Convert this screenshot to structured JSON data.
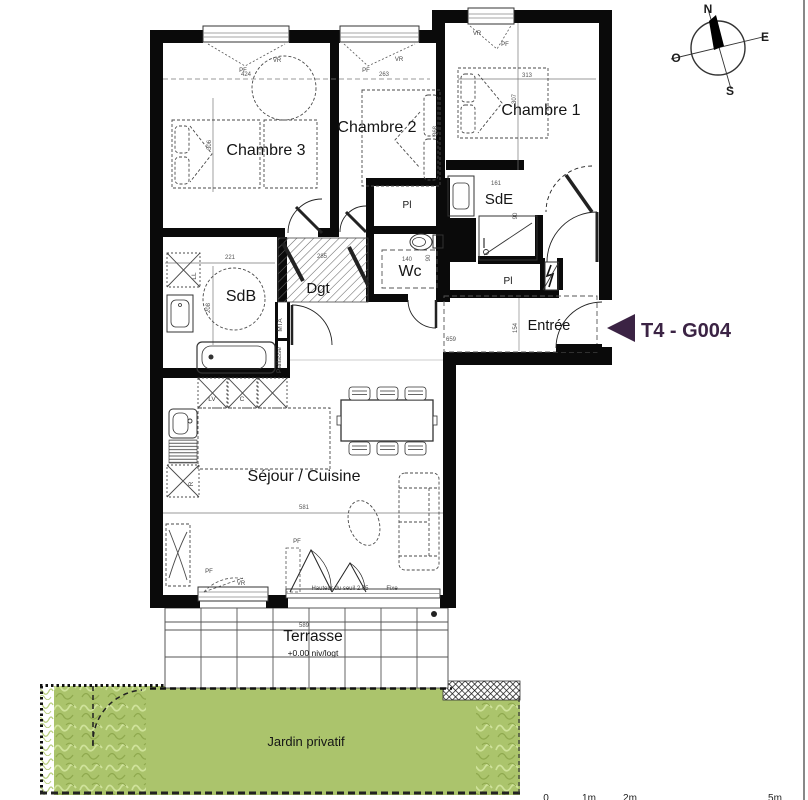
{
  "plan": {
    "type": "apartment-floor-plan",
    "unit": "T4 - G004"
  },
  "colors": {
    "wall": "#0a0a0a",
    "title_color": "#3b2344",
    "garden": "#abc46c",
    "hedge_light": "#cfe29b",
    "hedge_dark": "#8fa94e",
    "outer_hedge": "#b9cf7e"
  },
  "labels": {
    "title": [
      {
        "n": "plan-title",
        "t": "T4 - G004",
        "x": 641,
        "y": 337,
        "s": 20
      }
    ],
    "rooms": [
      {
        "n": "room-label-chambre-3",
        "t": "Chambre 3",
        "x": 266,
        "y": 155,
        "s": 16
      },
      {
        "n": "room-label-chambre-2",
        "t": "Chambre 2",
        "x": 377,
        "y": 132,
        "s": 16
      },
      {
        "n": "room-label-chambre-1",
        "t": "Chambre 1",
        "x": 541,
        "y": 115,
        "s": 16
      },
      {
        "n": "room-label-sdb",
        "t": "SdB",
        "x": 241,
        "y": 301,
        "s": 16
      },
      {
        "n": "room-label-sde",
        "t": "SdE",
        "x": 499,
        "y": 204,
        "s": 15
      },
      {
        "n": "room-label-wc",
        "t": "Wc",
        "x": 410,
        "y": 276,
        "s": 16
      },
      {
        "n": "room-label-dgt",
        "t": "Dgt",
        "x": 318,
        "y": 293,
        "s": 15
      },
      {
        "n": "room-label-pl-top",
        "t": "Pl",
        "x": 407,
        "y": 208,
        "s": 10
      },
      {
        "n": "room-label-pl-bottom",
        "t": "Pl",
        "x": 508,
        "y": 284,
        "s": 10
      },
      {
        "n": "room-label-entree",
        "t": "Entrée",
        "x": 549,
        "y": 330,
        "s": 14.5
      },
      {
        "n": "room-label-sejour-cuisine",
        "t": "Séjour / Cuisine",
        "x": 304,
        "y": 481,
        "s": 16
      },
      {
        "n": "room-label-terrasse",
        "t": "Terrasse",
        "x": 313,
        "y": 641,
        "s": 15.5
      },
      {
        "n": "terrasse-level-note",
        "t": "+0.00 niv/logt",
        "x": 313,
        "y": 656,
        "s": 8.5
      },
      {
        "n": "room-label-jardin-privatif",
        "t": "Jardin privatif",
        "x": 306,
        "y": 746,
        "s": 13
      }
    ],
    "dimensions": [
      {
        "n": "dim-424",
        "t": "424",
        "x": 246,
        "y": 76
      },
      {
        "n": "dim-306",
        "t": "306",
        "x": 211,
        "y": 145,
        "r": -90
      },
      {
        "n": "dim-263",
        "t": "263",
        "x": 384,
        "y": 76
      },
      {
        "n": "dim-368",
        "t": "368",
        "x": 437,
        "y": 131,
        "r": -90
      },
      {
        "n": "dim-313",
        "t": "313",
        "x": 527,
        "y": 77
      },
      {
        "n": "dim-307",
        "t": "307",
        "x": 516,
        "y": 99,
        "r": -90
      },
      {
        "n": "dim-221",
        "t": "221",
        "x": 230,
        "y": 259
      },
      {
        "n": "dim-208",
        "t": "208",
        "x": 210,
        "y": 308,
        "r": -90
      },
      {
        "n": "dim-285",
        "t": "285",
        "x": 322,
        "y": 258
      },
      {
        "n": "dim-140",
        "t": "140",
        "x": 407,
        "y": 261
      },
      {
        "n": "dim-90-wc",
        "t": "90",
        "x": 430,
        "y": 258,
        "r": -90
      },
      {
        "n": "dim-161",
        "t": "161",
        "x": 496,
        "y": 185
      },
      {
        "n": "dim-90-sde",
        "t": "90",
        "x": 517,
        "y": 216,
        "r": -90
      },
      {
        "n": "dim-659",
        "t": "659",
        "x": 451,
        "y": 341
      },
      {
        "n": "dim-154",
        "t": "154",
        "x": 517,
        "y": 328,
        "r": -90
      },
      {
        "n": "dim-581",
        "t": "581",
        "x": 304,
        "y": 509
      },
      {
        "n": "dim-589",
        "t": "589",
        "x": 304,
        "y": 627
      }
    ],
    "windows": [
      {
        "n": "window-label-vr-ch3",
        "t": "VR",
        "x": 277,
        "y": 62
      },
      {
        "n": "window-label-pf-ch3",
        "t": "PF",
        "x": 243,
        "y": 72
      },
      {
        "n": "window-label-vr-ch2",
        "t": "VR",
        "x": 399,
        "y": 61
      },
      {
        "n": "window-label-pf-ch2",
        "t": "PF",
        "x": 366,
        "y": 72
      },
      {
        "n": "window-label-vr-ch1",
        "t": "VR",
        "x": 477,
        "y": 35
      },
      {
        "n": "window-label-pf-ch1",
        "t": "PF",
        "x": 505,
        "y": 46
      },
      {
        "n": "window-label-pf-sejour-left",
        "t": "PF",
        "x": 209,
        "y": 573
      },
      {
        "n": "window-label-vr-sejour-left",
        "t": "VR",
        "x": 241,
        "y": 585
      },
      {
        "n": "window-label-pf-bay",
        "t": "PF",
        "x": 297,
        "y": 543
      },
      {
        "n": "window-label-seuil",
        "t": "Hauteur du seuil 2.05",
        "x": 340,
        "y": 590,
        "s": 5.5
      },
      {
        "n": "window-label-fixe",
        "t": "Fixe",
        "x": 392,
        "y": 590
      }
    ],
    "fixtures": [
      {
        "n": "fixture-label-lv",
        "t": "LV",
        "x": 212,
        "y": 401
      },
      {
        "n": "fixture-label-c",
        "t": "C",
        "x": 242,
        "y": 401
      },
      {
        "n": "fixture-label-r",
        "t": "R",
        "x": 193,
        "y": 484,
        "r": -90
      },
      {
        "n": "fixture-label-ll",
        "t": "LL",
        "x": 196,
        "y": 276,
        "r": -90
      },
      {
        "n": "fixture-label-mta",
        "t": "MTA",
        "x": 282,
        "y": 325,
        "r": -90,
        "s": 5.5
      },
      {
        "n": "fixture-label-paillasse",
        "t": "Paillasse",
        "x": 281,
        "y": 360,
        "r": -90,
        "s": 5
      }
    ],
    "compass": [
      {
        "n": "compass-n",
        "t": "N",
        "x": 708,
        "y": 13,
        "s": 12
      },
      {
        "n": "compass-e",
        "t": "E",
        "x": 765,
        "y": 41,
        "s": 12
      },
      {
        "n": "compass-o",
        "t": "O",
        "x": 676,
        "y": 62,
        "s": 12
      },
      {
        "n": "compass-s",
        "t": "S",
        "x": 730,
        "y": 95,
        "s": 12
      }
    ],
    "scale": [
      {
        "n": "scale-0",
        "t": "0",
        "x": 546,
        "y": 801
      },
      {
        "n": "scale-1m",
        "t": "1m",
        "x": 589,
        "y": 801
      },
      {
        "n": "scale-2m",
        "t": "2m",
        "x": 630,
        "y": 801
      },
      {
        "n": "scale-5m",
        "t": "5m",
        "x": 775,
        "y": 801
      }
    ]
  }
}
